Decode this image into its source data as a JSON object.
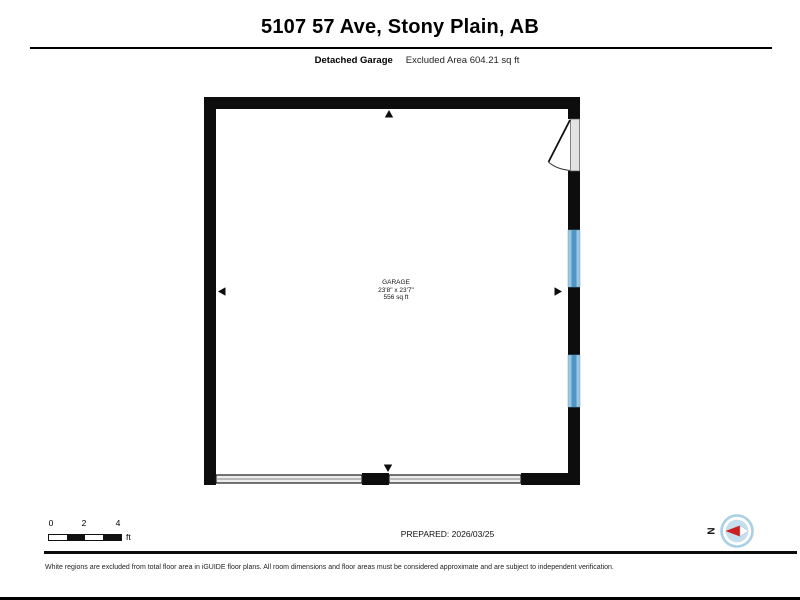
{
  "header": {
    "title": "5107 57 Ave, Stony Plain, AB",
    "subtitle_bold": "Detached Garage",
    "subtitle_rest": "Excluded Area 604.21 sq ft"
  },
  "plan": {
    "room_name": "GARAGE",
    "room_dimensions": "23'8\" x 23'7\"",
    "room_area": "556 sq ft"
  },
  "scale_bar": {
    "ticks": [
      "0",
      "2",
      "4"
    ],
    "unit": "ft"
  },
  "compass": {
    "label": "N"
  },
  "footer": {
    "prepared_label": "PREPARED: 2026/03/25",
    "disclaimer": "White regions are excluded from total floor area in iGUIDE floor plans. All room dimensions and floor areas must be considered approximate and are subject to independent verification."
  },
  "colors": {
    "wall": "#0d0d0d",
    "window_fill": "#9cc6e0",
    "window_center": "#4e96c6",
    "garage_door_fill": "#ededed",
    "door_panel_fill": "#e3e3e3",
    "compass_ring": "#a8cfe4",
    "compass_disc": "#c6dfee",
    "compass_needle_red": "#cc2020"
  }
}
